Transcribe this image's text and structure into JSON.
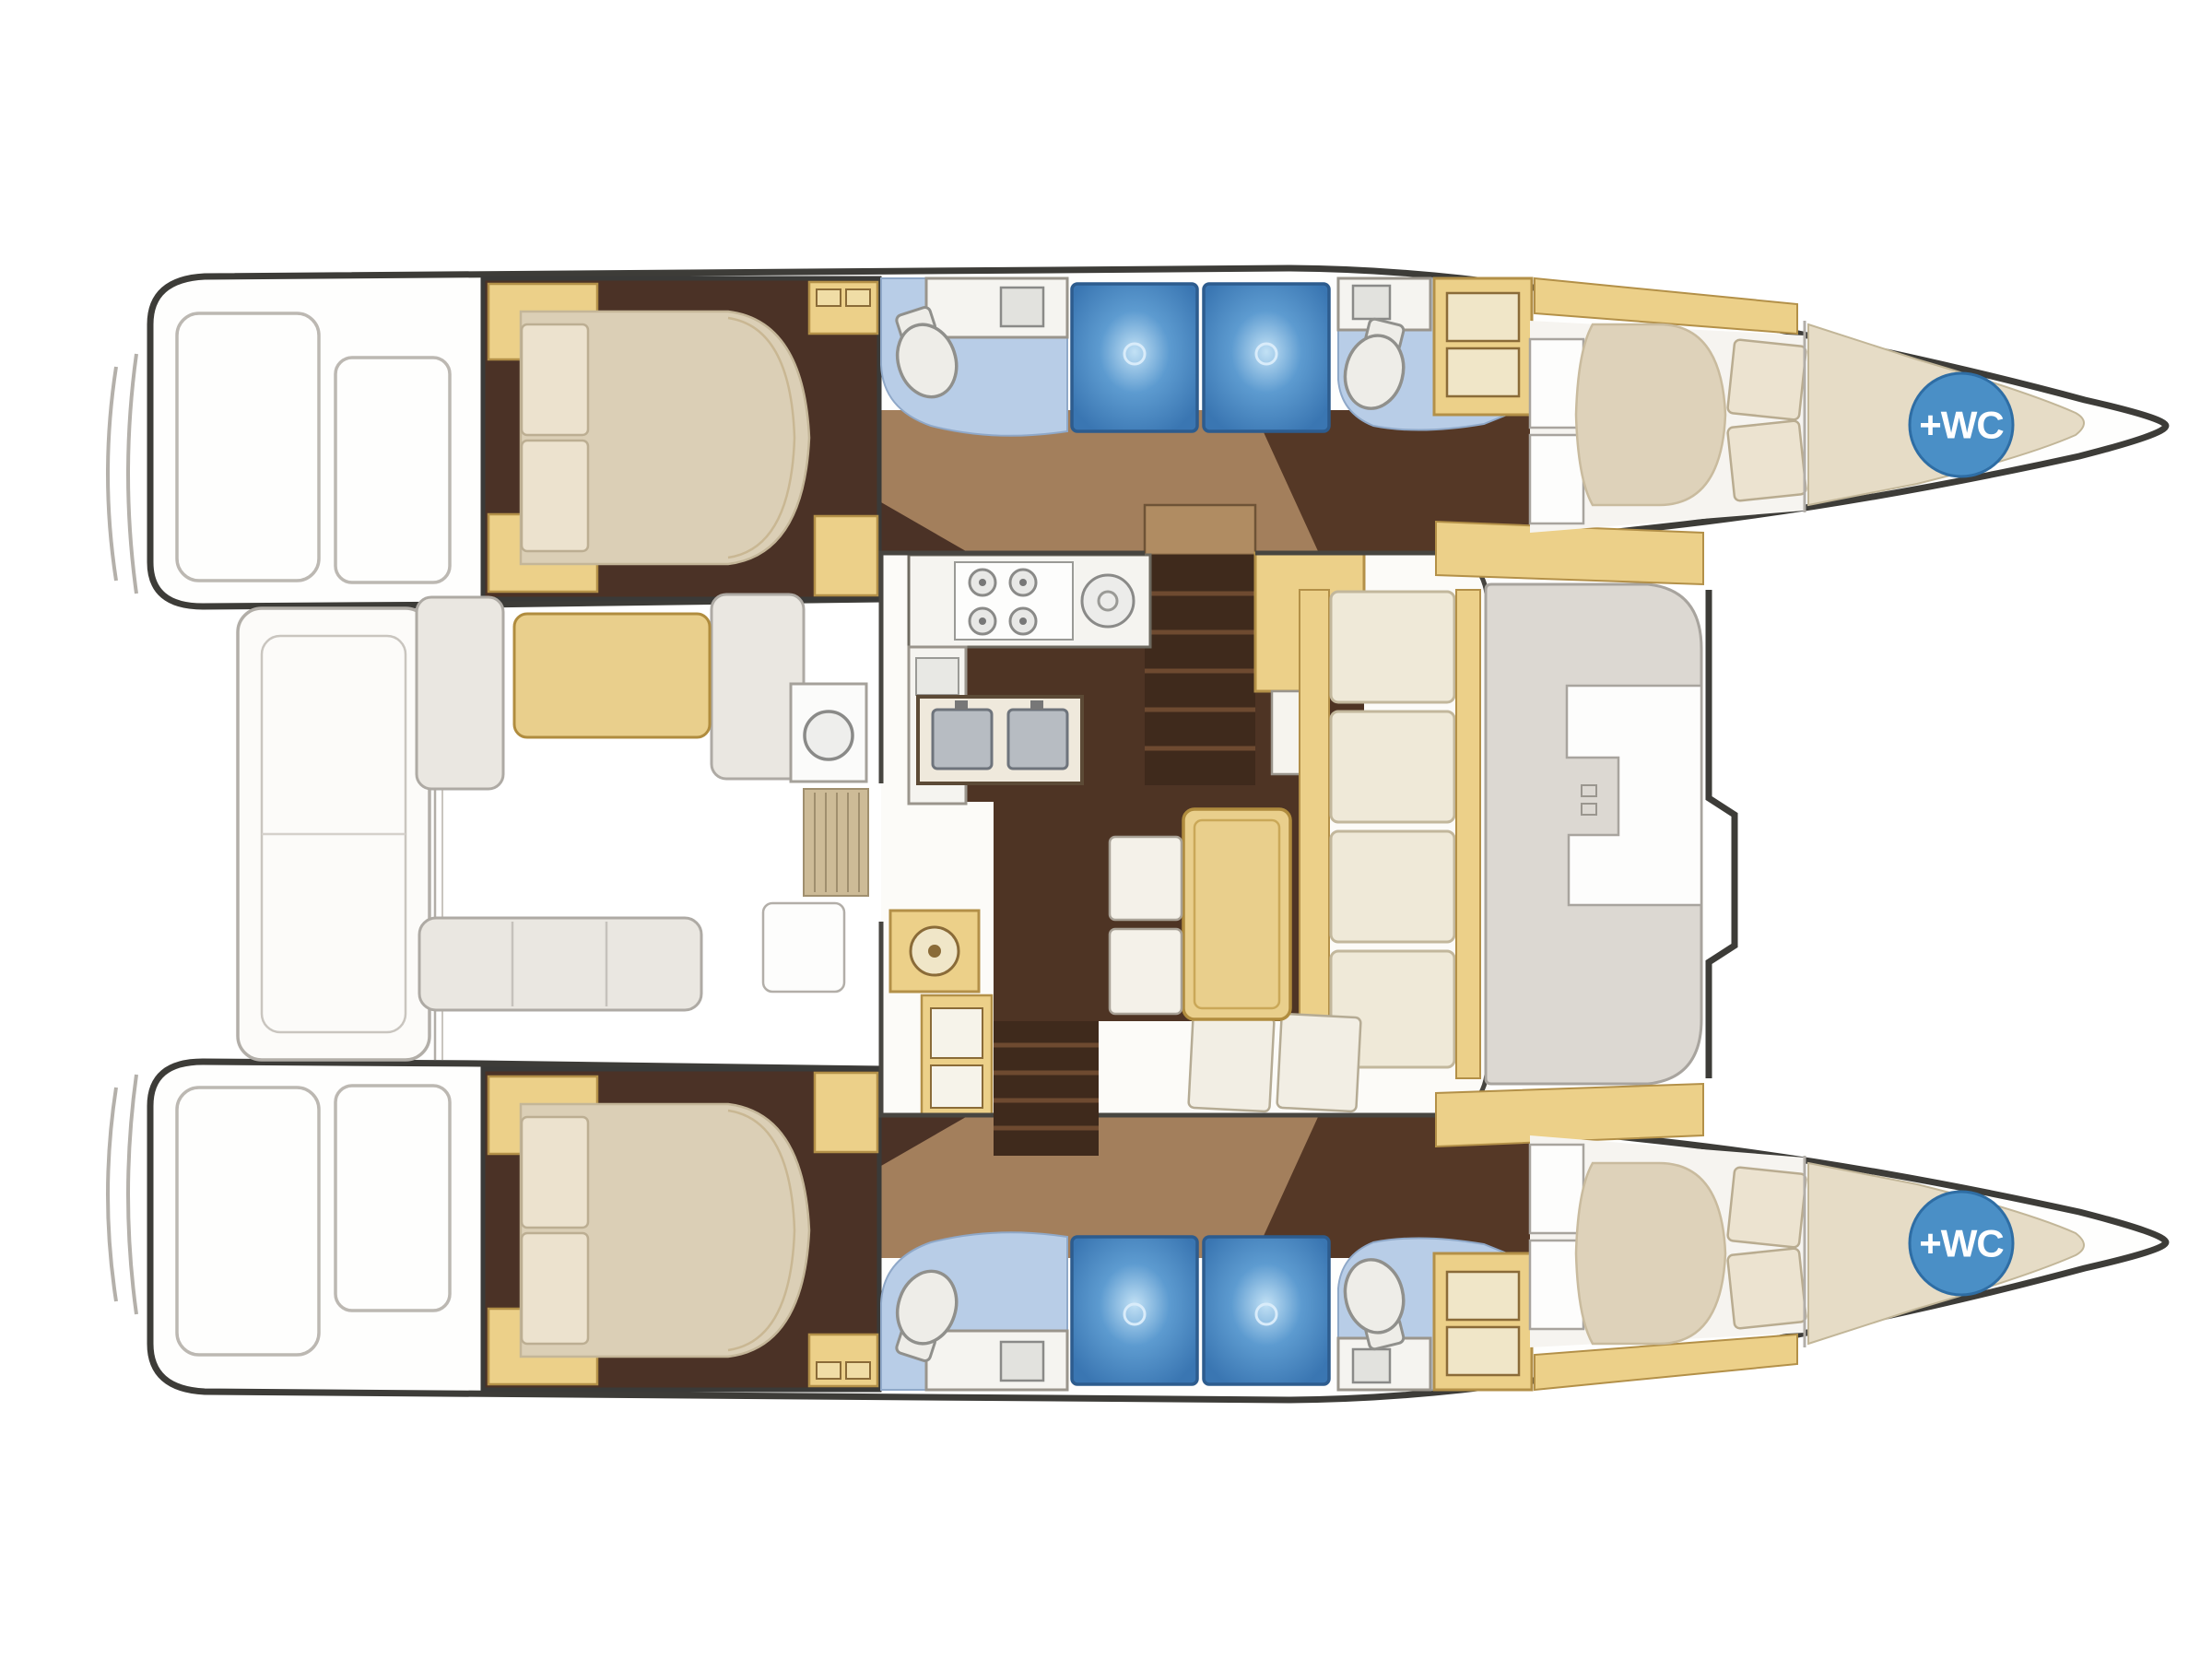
{
  "diagram": {
    "title": "Catamaran interior deck plan",
    "type": "boat-floor-plan",
    "orientation": {
      "bow_side": "right",
      "stern_side": "left",
      "hulls": 2
    },
    "badges": {
      "bow_wc_label": "+WC",
      "bow_wc_count": 2
    },
    "colors": {
      "hull_outline": "#3d3c38",
      "wall": "#474540",
      "deck_line": "#b4b0aa",
      "deck_fill": "#e9e6e1",
      "cabin_floor": "#4b3226",
      "salon_floor_dark": "#4e3424",
      "corridor_tan": "#a37f5c",
      "cabinet_yellow": "#ecd089",
      "cabinet_border": "#b39048",
      "bed_beige": "#dbcfb6",
      "pillow": "#ece2ce",
      "bath_floor_blue": "#b8cde7",
      "shower_blue": "#4079b4",
      "wc_badge": "#4a8fc6",
      "counter_white": "#f5f4f0"
    },
    "rooms": {
      "cabins": [
        {
          "name": "aft-cabin-port",
          "bed": "double-bed",
          "pillows": 2
        },
        {
          "name": "aft-cabin-starboard",
          "bed": "double-bed",
          "pillows": 2
        },
        {
          "name": "forward-cabin-port",
          "bed": "double-bed",
          "pillows": 2
        },
        {
          "name": "forward-cabin-starboard",
          "bed": "double-bed",
          "pillows": 2
        }
      ],
      "heads": [
        {
          "name": "aft-head-port",
          "fixtures": [
            "toilet",
            "vanity-sink"
          ]
        },
        {
          "name": "forward-head-port",
          "fixtures": [
            "toilet",
            "vanity-sink",
            "drawer-cabinet"
          ]
        },
        {
          "name": "aft-head-starboard",
          "fixtures": [
            "toilet",
            "vanity-sink"
          ]
        },
        {
          "name": "forward-head-starboard",
          "fixtures": [
            "toilet",
            "vanity-sink",
            "drawer-cabinet"
          ]
        }
      ],
      "showers": {
        "count": 4
      },
      "bow_crew_wc": {
        "count": 2,
        "label": "+WC"
      },
      "galley": {
        "stove_burners": 4,
        "round_sink": 1,
        "double_sink": 1,
        "appliance_round_door": 1
      },
      "salon": {
        "dinette_table": 1,
        "settee_cushions": 4,
        "bench_cushions": 2,
        "chairs": 2,
        "nav_panel": 1,
        "companionway_stairs": 2
      },
      "aft_cockpit": {
        "table": 1,
        "benches": 3
      },
      "forward_cockpit": {
        "seat": 1
      },
      "transom_platform": 1
    }
  }
}
